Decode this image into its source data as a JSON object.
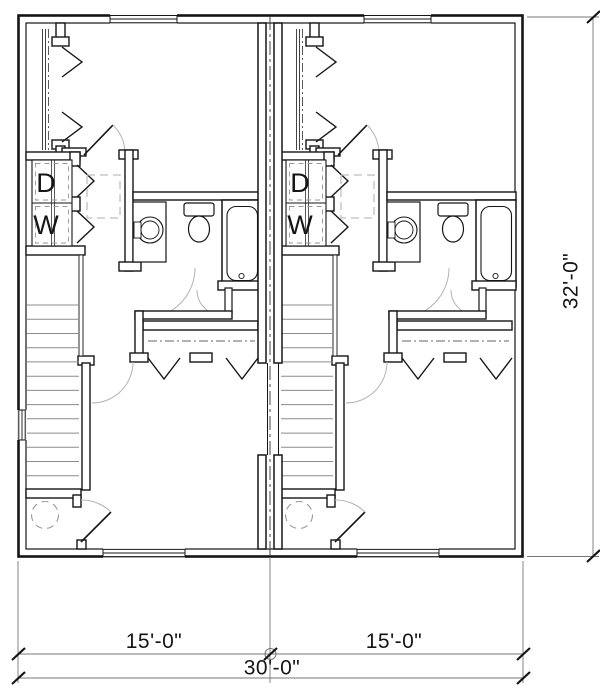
{
  "plan": {
    "type": "duplex-floor-plan",
    "unit_count": 2
  },
  "labels": {
    "dryer": "D",
    "washer": "W"
  },
  "dimensions": {
    "unit1_width": "15'-0\"",
    "unit2_width": "15'-0\"",
    "total_width": "30'-0\"",
    "depth": "32'-0\""
  },
  "colors": {
    "wall_line": "#151515",
    "light_arc": "#b3b3b3",
    "stair_tread": "#8c8c8c",
    "dashed_gray": "#bfbfbf",
    "dim_line": "#777777"
  }
}
